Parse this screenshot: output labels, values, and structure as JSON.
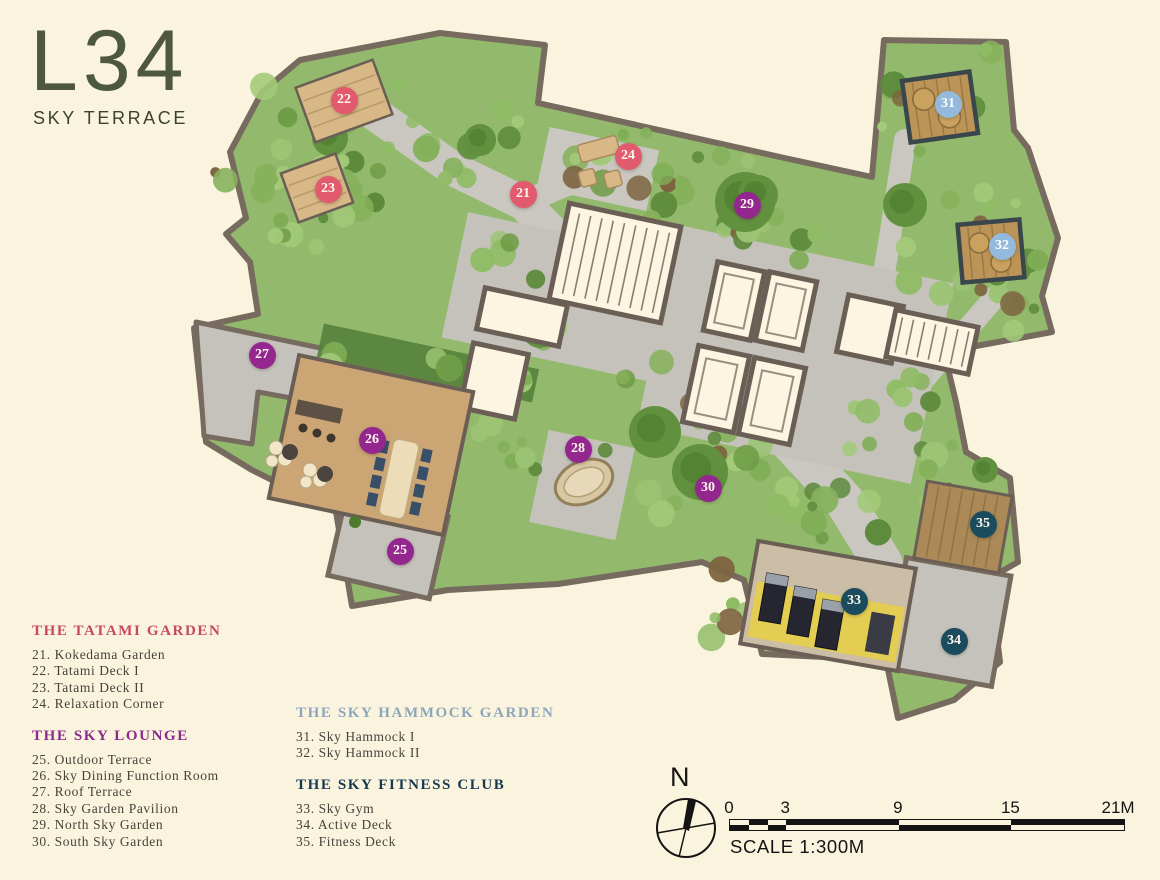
{
  "page": {
    "background": "#faf4df"
  },
  "title": {
    "main": "L34",
    "subtitle": "SKY TERRACE"
  },
  "legend": {
    "groups": [
      {
        "name": "THE TATAMI GARDEN",
        "heading_color": "#c8495c",
        "marker_color": "#e25a6e",
        "marker_text_color": "#fdf7ea",
        "items": [
          "21. Kokedama Garden",
          "22. Tatami Deck I",
          "23. Tatami Deck II",
          "24. Relaxation Corner"
        ]
      },
      {
        "name": "THE SKY LOUNGE",
        "heading_color": "#8c2a8c",
        "marker_color": "#93278f",
        "marker_text_color": "#fdf7ea",
        "items": [
          "25. Outdoor Terrace",
          "26. Sky Dining Function Room",
          "27. Roof Terrace",
          "28. Sky Garden Pavilion",
          "29. North Sky Garden",
          "30. South Sky Garden"
        ]
      },
      {
        "name": "THE SKY HAMMOCK GARDEN",
        "heading_color": "#8da6bb",
        "marker_color": "#93b9dc",
        "marker_text_color": "#ffffff",
        "items": [
          "31. Sky Hammock I",
          "32. Sky Hammock II"
        ]
      },
      {
        "name": "THE SKY FITNESS CLUB",
        "heading_color": "#16394f",
        "marker_color": "#1a4c5e",
        "marker_text_color": "#fdf7ea",
        "items": [
          "33. Sky Gym",
          "34. Active Deck",
          "35. Fitness Deck"
        ]
      }
    ]
  },
  "plan": {
    "markers": [
      {
        "num": "21",
        "x": 523,
        "y": 194,
        "group": 0
      },
      {
        "num": "22",
        "x": 344,
        "y": 100,
        "group": 0
      },
      {
        "num": "23",
        "x": 328,
        "y": 189,
        "group": 0
      },
      {
        "num": "24",
        "x": 628,
        "y": 156,
        "group": 0
      },
      {
        "num": "25",
        "x": 400,
        "y": 551,
        "group": 1
      },
      {
        "num": "26",
        "x": 372,
        "y": 440,
        "group": 1
      },
      {
        "num": "27",
        "x": 262,
        "y": 355,
        "group": 1
      },
      {
        "num": "28",
        "x": 578,
        "y": 449,
        "group": 1
      },
      {
        "num": "29",
        "x": 747,
        "y": 205,
        "group": 1
      },
      {
        "num": "30",
        "x": 708,
        "y": 488,
        "group": 1
      },
      {
        "num": "31",
        "x": 948,
        "y": 104,
        "group": 2
      },
      {
        "num": "32",
        "x": 1002,
        "y": 246,
        "group": 2
      },
      {
        "num": "33",
        "x": 854,
        "y": 601,
        "group": 3
      },
      {
        "num": "34",
        "x": 954,
        "y": 641,
        "group": 3
      },
      {
        "num": "35",
        "x": 983,
        "y": 524,
        "group": 3
      }
    ]
  },
  "compass": {
    "label": "N"
  },
  "scale_bar": {
    "ticks": [
      {
        "label": "0",
        "m": 0
      },
      {
        "label": "3",
        "m": 3
      },
      {
        "label": "9",
        "m": 9
      },
      {
        "label": "15",
        "m": 15
      },
      {
        "label": "21M",
        "m": 21
      }
    ],
    "caption": "SCALE 1:300M",
    "length_m": 21
  }
}
